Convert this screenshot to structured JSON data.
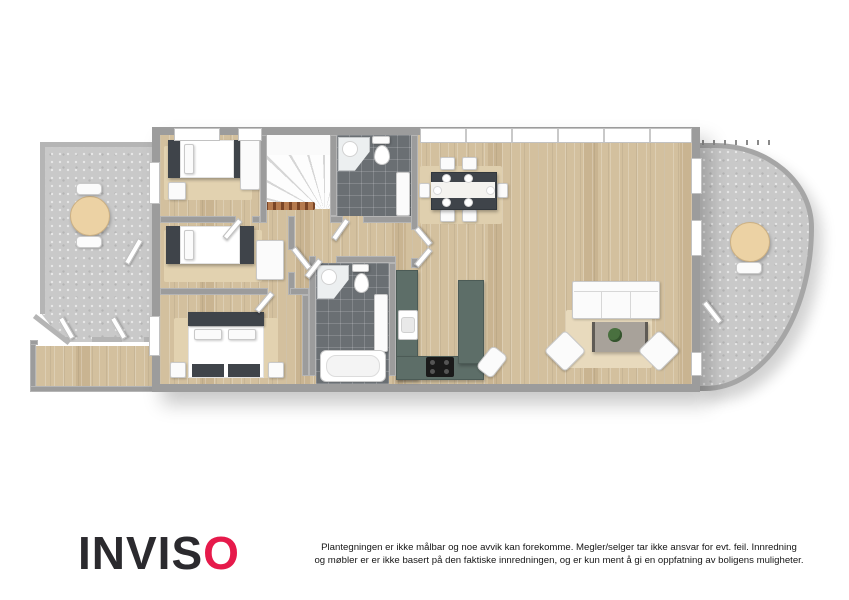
{
  "footer": {
    "logo_main": "INVIS",
    "logo_accent": "O",
    "disclaimer_line1": "Plantegningen er ikke målbar og noe avvik kan forekomme. Megler/selger tar ikke ansvar for evt. feil. Innredning",
    "disclaimer_line2": "og møbler er er ikke basert på den faktiske innredningen, og er kun ment å gi en oppfatning av boligens muligheter."
  },
  "palette": {
    "brand_accent": "#e61a4b",
    "logo_text": "#2b2a2e",
    "wall_gray": "#9c9c9c",
    "wood_floor": "#d3c09e",
    "stone_floor": "#c9c9c9",
    "tile_dark": "#6a6f73",
    "kitchen_counter": "#5d6e68",
    "dark_furniture": "#3f444a",
    "rug_beige": "#e2d2b0"
  },
  "plan": {
    "type": "3d-floorplan-top-view",
    "rooms": [
      "terrace-left",
      "entry-hall",
      "bedroom-1",
      "bedroom-2",
      "bedroom-3",
      "stairs",
      "bathroom-small",
      "bathroom-main",
      "hallway",
      "kitchen",
      "dining-area",
      "living-room",
      "balcony-right"
    ]
  }
}
